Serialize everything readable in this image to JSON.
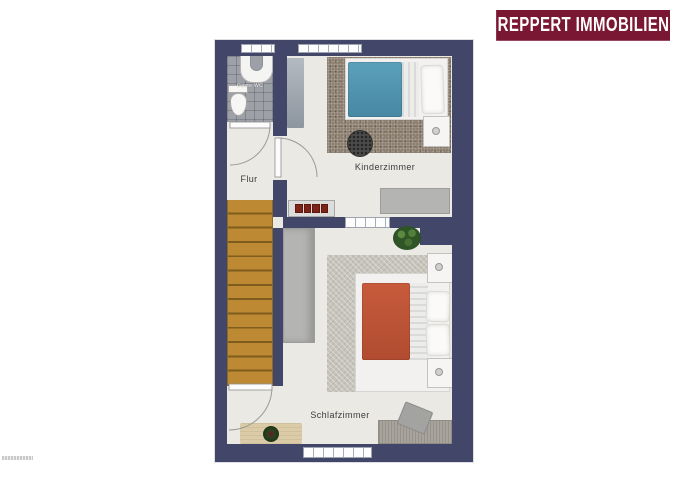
{
  "brand": {
    "name": "REPPERT IMMOBILIEN"
  },
  "plan": {
    "rooms": {
      "wc": {
        "label": "Gäste WC"
      },
      "flur": {
        "label": "Flur"
      },
      "kinder": {
        "label": "Kinderzimmer"
      },
      "schlaf": {
        "label": "Schlafzimmer"
      }
    },
    "furniture": [
      "staircase",
      "kids-single-bed",
      "nightstand",
      "pouf",
      "gray-rug",
      "dresser",
      "radiator",
      "toilet",
      "washbasin",
      "wardrobe",
      "double-bed",
      "pillows",
      "desk",
      "chair",
      "beige-rug",
      "potted-plant",
      "potted-plant"
    ]
  },
  "colors": {
    "wall": "#424769",
    "floor": "#eae9e4",
    "logo_bg": "#7a1733",
    "logo_text": "#ffffff",
    "stairs_wood": "#b9862e",
    "kids_duvet_blue": "#4e95b0",
    "master_duvet_orange": "#bf5537",
    "kinder_carpet": "#8c7f6f",
    "schlaf_carpet": "#c7c4bb",
    "bath_tile": "#9da0a6"
  }
}
